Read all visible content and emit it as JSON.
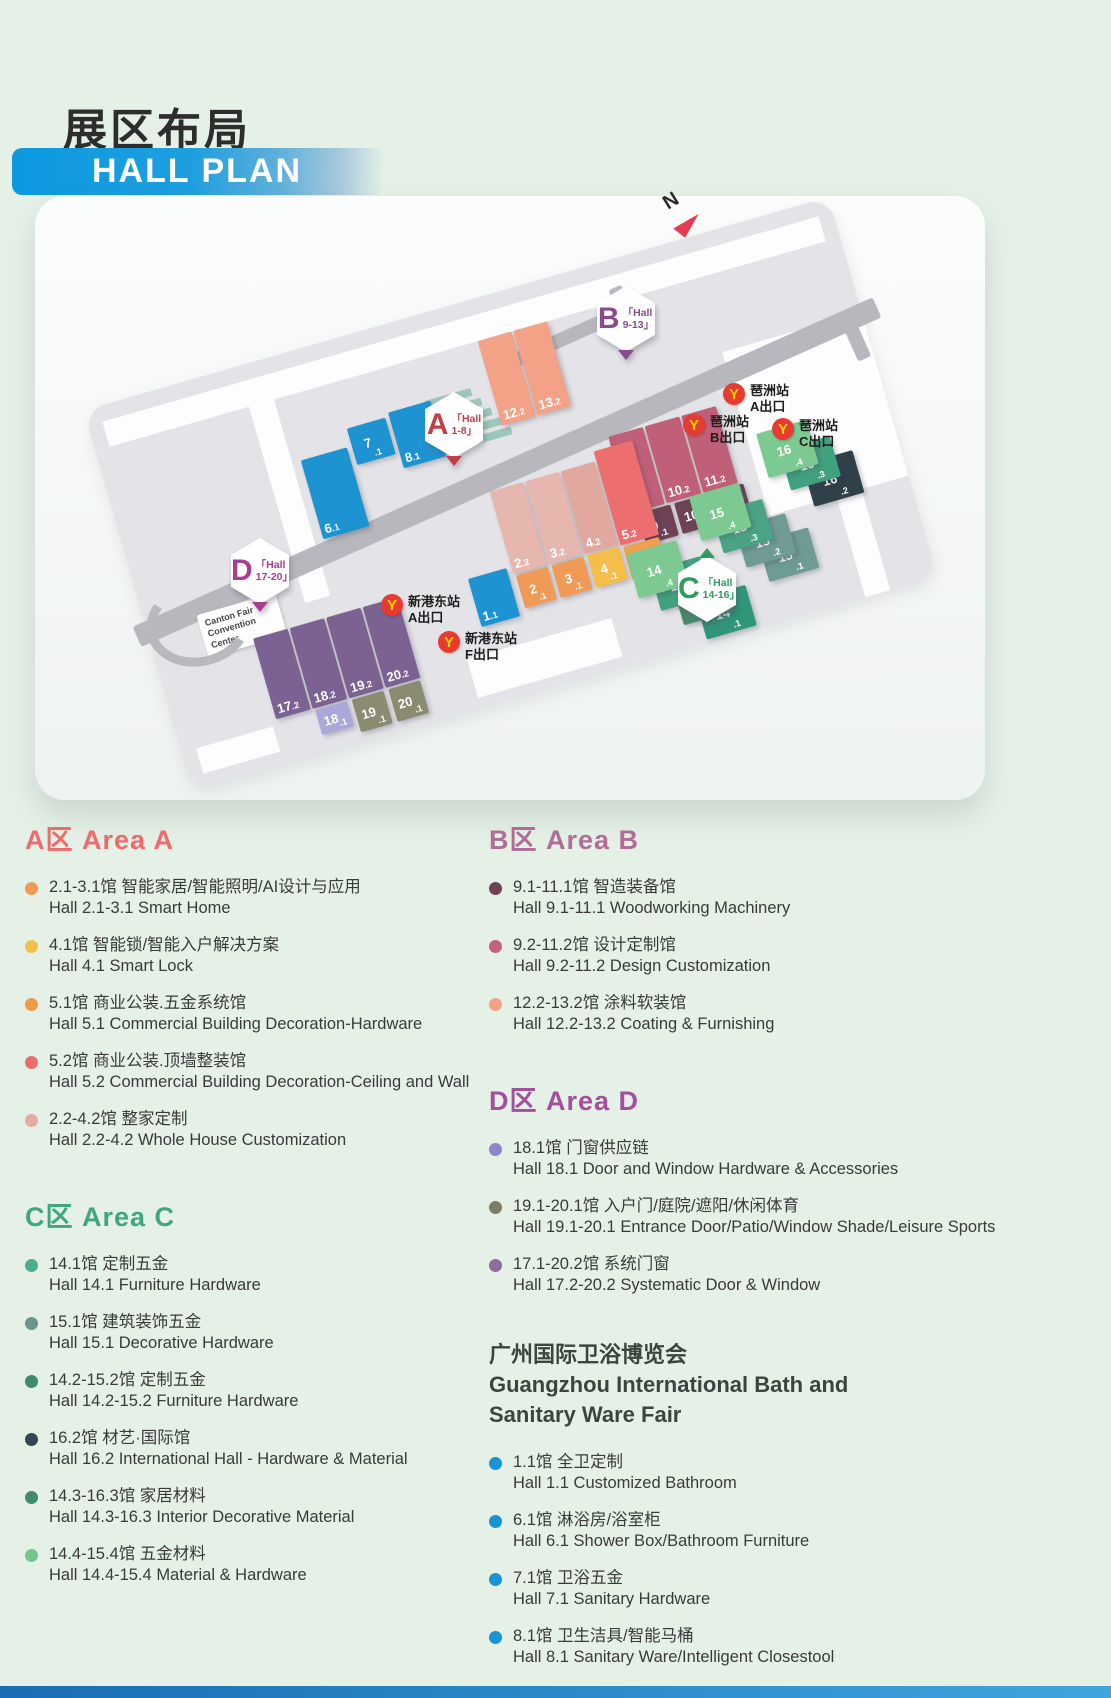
{
  "header": {
    "title_cn": "展区布局",
    "title_en": "HALL PLAN"
  },
  "map": {
    "compass": "N",
    "ground_color": "#e4e4e8",
    "walkway_color": "#b7b7bd",
    "convention_center": [
      "Canton Fair",
      "Convention",
      "Center"
    ],
    "areas": [
      {
        "id": "A",
        "letter": "A",
        "line1": "「Hall",
        "line2": "1-8」",
        "color": "#bf4147",
        "pointer": "bottom"
      },
      {
        "id": "B",
        "letter": "B",
        "line1": "「Hall",
        "line2": "9-13」",
        "color": "#8a4b8d",
        "pointer": "bottom"
      },
      {
        "id": "C",
        "letter": "C",
        "line1": "「Hall",
        "line2": "14-16」",
        "color": "#2f9b5e",
        "pointer": "top"
      },
      {
        "id": "D",
        "letter": "D",
        "line1": "「Hall",
        "line2": "17-20」",
        "color": "#a83d92",
        "pointer": "bottom"
      }
    ],
    "stations": [
      {
        "id": "pazhou-a",
        "name": "琶洲站",
        "exit": "A出口"
      },
      {
        "id": "pazhou-b",
        "name": "琶洲站",
        "exit": "B出口"
      },
      {
        "id": "pazhou-c",
        "name": "琶洲站",
        "exit": "C出口"
      },
      {
        "id": "xingang-a",
        "name": "新港东站",
        "exit": "A出口"
      },
      {
        "id": "xingang-f",
        "name": "新港东站",
        "exit": "F出口"
      }
    ],
    "metro": {
      "circle": "#e73b31",
      "glyph": "#ffd200",
      "glyph_char": "Y"
    },
    "halls": [
      {
        "id": "12.2",
        "color": "#f4a287"
      },
      {
        "id": "13.2",
        "color": "#f4a287"
      },
      {
        "id": "9.2",
        "color": "#c06078"
      },
      {
        "id": "10.2",
        "color": "#c06078"
      },
      {
        "id": "11.2",
        "color": "#c06078"
      },
      {
        "id": "9.1",
        "color": "#6d4355"
      },
      {
        "id": "10.1",
        "color": "#6d4355"
      },
      {
        "id": "11.1",
        "color": "#6d4355"
      },
      {
        "id": "6.1",
        "color": "#1e93d2"
      },
      {
        "id": "7.1",
        "color": "#1e93d2"
      },
      {
        "id": "8.1",
        "color": "#1e93d2"
      },
      {
        "id": "2.2",
        "color": "#e6b7af"
      },
      {
        "id": "3.2",
        "color": "#e6b7af"
      },
      {
        "id": "4.2",
        "color": "#e0a89e"
      },
      {
        "id": "5.2",
        "color": "#ec6e6e"
      },
      {
        "id": "2.1",
        "color": "#f09a58"
      },
      {
        "id": "3.1",
        "color": "#f09a58"
      },
      {
        "id": "4.1",
        "color": "#f5bd4a"
      },
      {
        "id": "5.1",
        "color": "#f09f50"
      },
      {
        "id": "1.1",
        "color": "#1e93d2"
      },
      {
        "id": "17.2",
        "color": "#7c6292"
      },
      {
        "id": "18.2",
        "color": "#7c6292"
      },
      {
        "id": "19.2",
        "color": "#7c6292"
      },
      {
        "id": "20.2",
        "color": "#7c6292"
      },
      {
        "id": "18.1",
        "color": "#aaa7d9"
      },
      {
        "id": "19.1",
        "color": "#8b8b71"
      },
      {
        "id": "20.1",
        "color": "#8b8b71"
      },
      {
        "id": "16.2",
        "color": "#2f4049"
      },
      {
        "id": "16.3",
        "color": "#41a07e"
      },
      {
        "id": "16.4",
        "color": "#7cc991"
      },
      {
        "id": "15.1",
        "color": "#709b95"
      },
      {
        "id": "15.2",
        "color": "#709b95"
      },
      {
        "id": "15.3",
        "color": "#4ba385"
      },
      {
        "id": "15.4",
        "color": "#7cc991"
      },
      {
        "id": "14.1",
        "color": "#2f9679"
      },
      {
        "id": "14.2",
        "color": "#478a6e"
      },
      {
        "id": "14.3",
        "color": "#41a07e"
      },
      {
        "id": "14.4",
        "color": "#7cc991"
      }
    ]
  },
  "legend": {
    "sections": [
      {
        "id": "area-a",
        "column": "left",
        "title": "A区 Area A",
        "color": "#ee6b6b",
        "items": [
          {
            "cn": "2.1-3.1馆  智能家居/智能照明/AI设计与应用",
            "en": "Hall 2.1-3.1 Smart Home",
            "dot": "#f09a53"
          },
          {
            "cn": "4.1馆  智能锁/智能入户解决方案",
            "en": "Hall 4.1 Smart Lock",
            "dot": "#eec14e"
          },
          {
            "cn": "5.1馆  商业公装.五金系统馆",
            "en": "Hall 5.1 Commercial Building Decoration-Hardware",
            "dot": "#ec9b47"
          },
          {
            "cn": "5.2馆  商业公装.顶墙整装馆",
            "en": "Hall 5.2 Commercial Building Decoration-Ceiling and Wall",
            "dot": "#ec6d6d"
          },
          {
            "cn": "2.2-4.2馆  整家定制",
            "en": "Hall 2.2-4.2 Whole House Customization",
            "dot": "#e2aba5"
          }
        ]
      },
      {
        "id": "area-c",
        "column": "left",
        "title": "C区 Area C",
        "color": "#3fa77c",
        "items": [
          {
            "cn": "14.1馆  定制五金",
            "en": "Hall 14.1 Furniture Hardware",
            "dot": "#4cae8e"
          },
          {
            "cn": "15.1馆  建筑装饰五金",
            "en": "Hall 15.1 Decorative Hardware",
            "dot": "#68968f"
          },
          {
            "cn": "14.2-15.2馆  定制五金",
            "en": "Hall 14.2-15.2 Furniture Hardware",
            "dot": "#3d8a70"
          },
          {
            "cn": "16.2馆  材艺·国际馆",
            "en": "Hall 16.2 International Hall - Hardware & Material",
            "dot": "#37454e"
          },
          {
            "cn": "14.3-16.3馆  家居材料",
            "en": "Hall 14.3-16.3 Interior Decorative Material",
            "dot": "#428b73"
          },
          {
            "cn": "14.4-15.4馆  五金材料",
            "en": "Hall 14.4-15.4 Material & Hardware",
            "dot": "#76c48d"
          }
        ]
      },
      {
        "id": "area-b",
        "column": "right",
        "title": "B区 Area B",
        "color": "#b06e97",
        "items": [
          {
            "cn": "9.1-11.1馆  智造装备馆",
            "en": "Hall 9.1-11.1 Woodworking Machinery",
            "dot": "#6d4355"
          },
          {
            "cn": "9.2-11.2馆  设计定制馆",
            "en": "Hall 9.2-11.2 Design Customization",
            "dot": "#c2627c"
          },
          {
            "cn": "12.2-13.2馆  涂料软装馆",
            "en": "Hall 12.2-13.2 Coating & Furnishing",
            "dot": "#f4a286"
          }
        ]
      },
      {
        "id": "area-d",
        "column": "right",
        "title": "D区 Area D",
        "color": "#a3509c",
        "items": [
          {
            "cn": "18.1馆  门窗供应链",
            "en": "Hall 18.1 Door and Window Hardware & Accessories",
            "dot": "#8e86cc"
          },
          {
            "cn": "19.1-20.1馆  入户门/庭院/遮阳/休闲体育",
            "en": "Hall 19.1-20.1 Entrance Door/Patio/Window Shade/Leisure Sports",
            "dot": "#7d7d66"
          },
          {
            "cn": "17.1-20.2馆  系统门窗",
            "en": "Hall 17.2-20.2 Systematic Door & Window",
            "dot": "#8d6b9e"
          }
        ]
      },
      {
        "id": "bath",
        "column": "right",
        "title_cn": "广州国际卫浴博览会",
        "title_en_lines": [
          "Guangzhou International Bath and",
          "Sanitary Ware Fair"
        ],
        "color": "#39463f",
        "items": [
          {
            "cn": "1.1馆  全卫定制",
            "en": "Hall 1.1  Customized Bathroom",
            "dot": "#1b92d1"
          },
          {
            "cn": "6.1馆  淋浴房/浴室柜",
            "en": "Hall 6.1 Shower Box/Bathroom Furniture",
            "dot": "#1b92d1"
          },
          {
            "cn": "7.1馆  卫浴五金",
            "en": "Hall 7.1 Sanitary Hardware",
            "dot": "#1b92d1"
          },
          {
            "cn": "8.1馆  卫生洁具/智能马桶",
            "en": "Hall 8.1 Sanitary Ware/Intelligent Closestool",
            "dot": "#1b92d1"
          }
        ]
      }
    ]
  }
}
